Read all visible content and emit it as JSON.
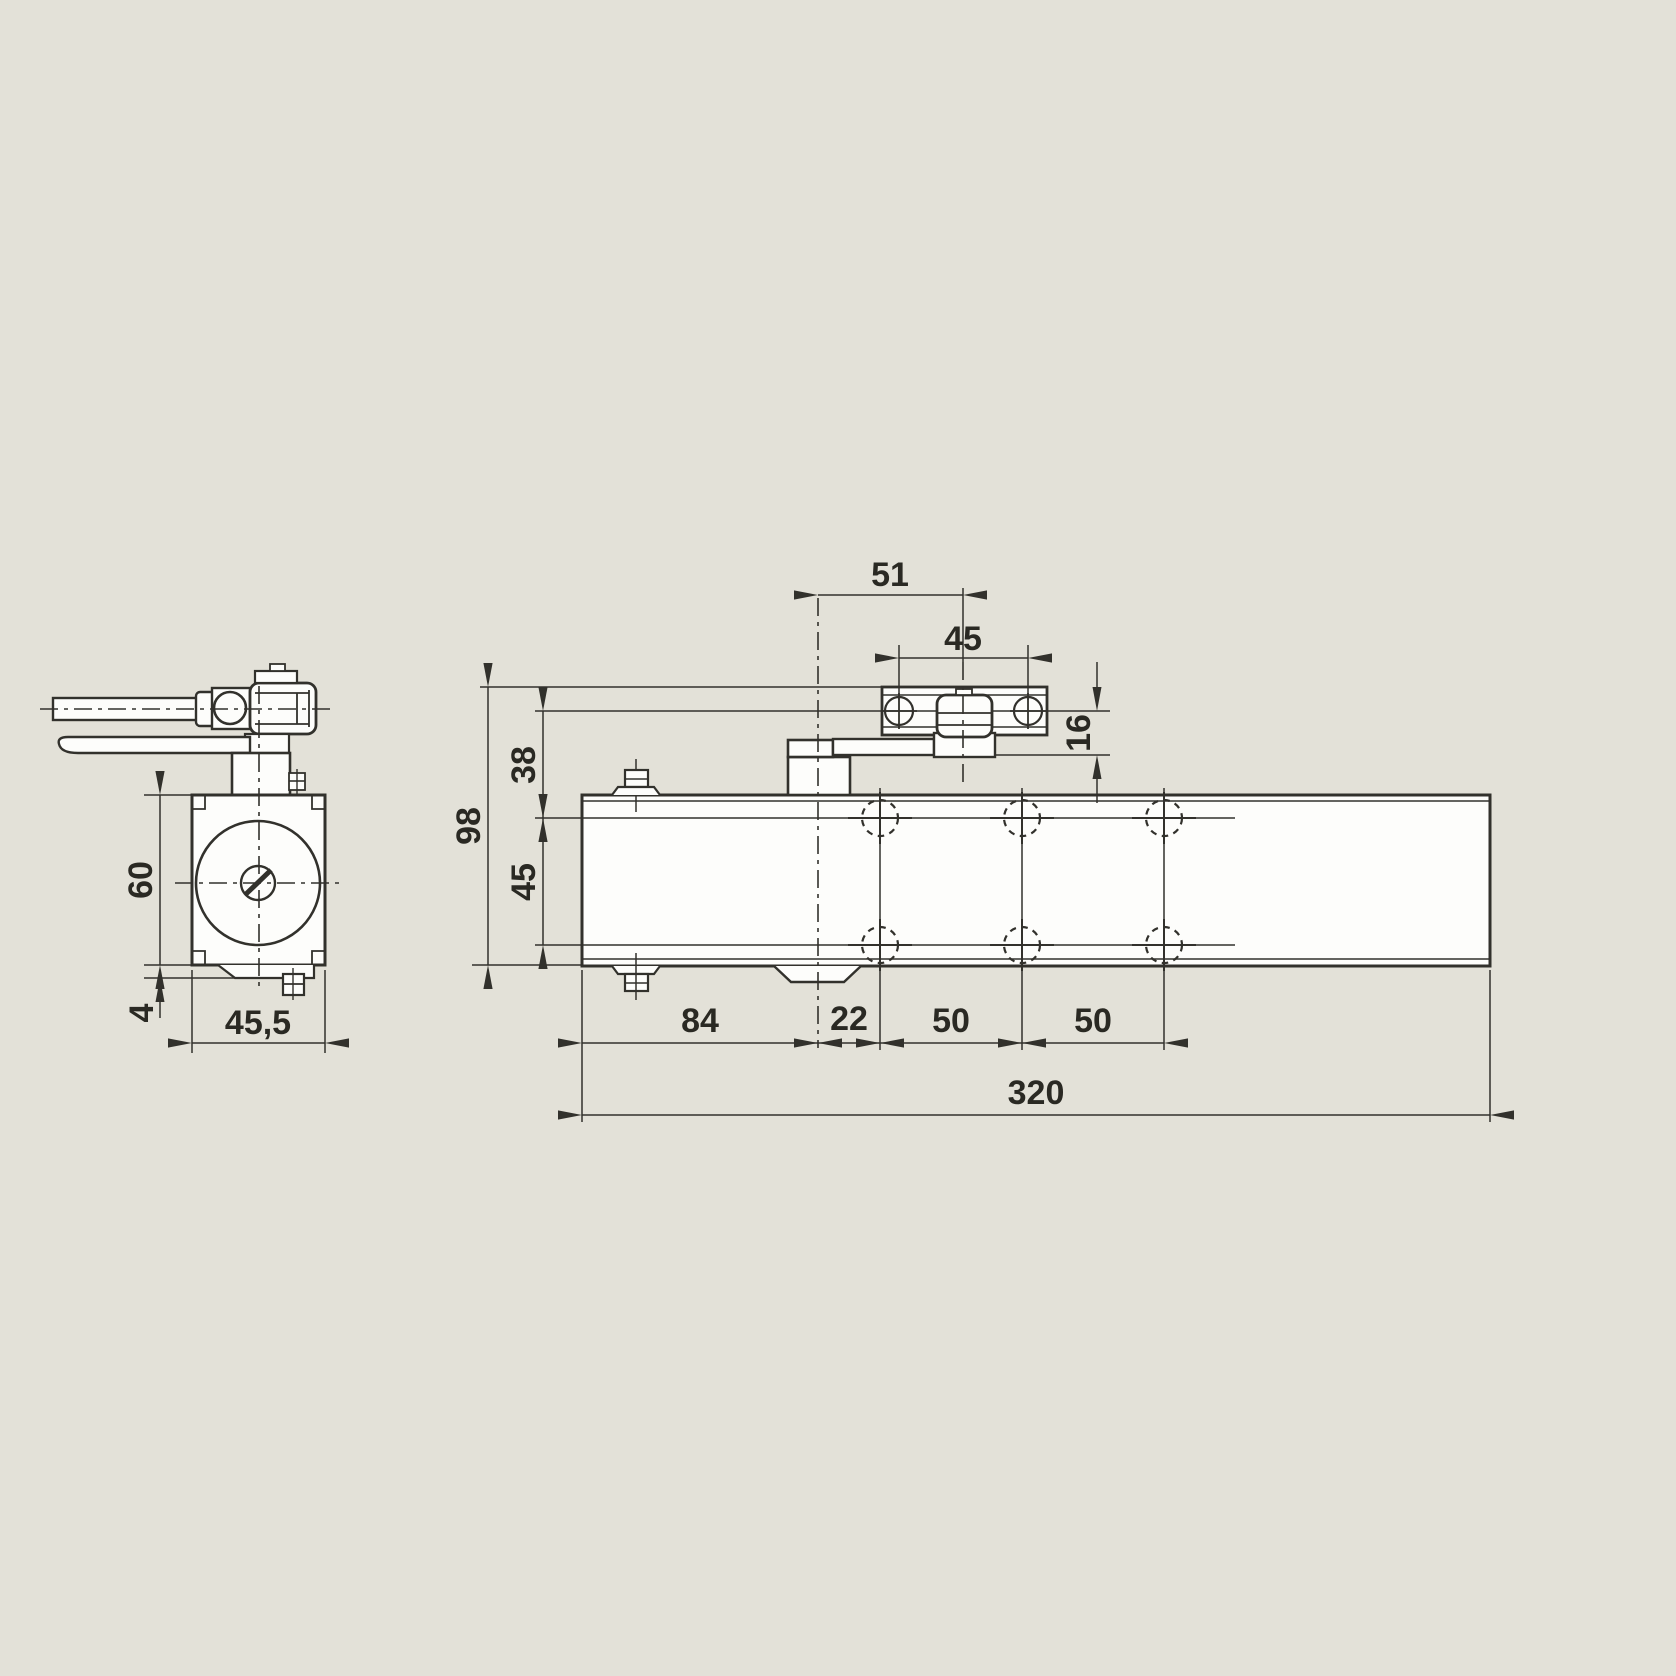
{
  "drawing": {
    "type": "technical-dimension-drawing",
    "subject": "overhead door closer, side view and front view",
    "colors": {
      "background": "#e3e1d8",
      "line": "#32312c",
      "fill": "#fdfdfb",
      "text": "#2a2923"
    },
    "side_view": {
      "dims": {
        "body_height": "60",
        "base_plate_offset": "4",
        "body_width": "45,5"
      }
    },
    "front_view": {
      "dims": {
        "pinion_to_rail_slider": "51",
        "rail_screw_spacing": "45",
        "rail_drop": "16",
        "overall_height": "98",
        "top_to_upper_hole_row": "38",
        "hole_row_spacing": "45",
        "end_to_pinion": "84",
        "pinion_to_first_hole_col": "22",
        "hole_col_spacing_1": "50",
        "hole_col_spacing_2": "50",
        "overall_length": "320"
      }
    }
  }
}
